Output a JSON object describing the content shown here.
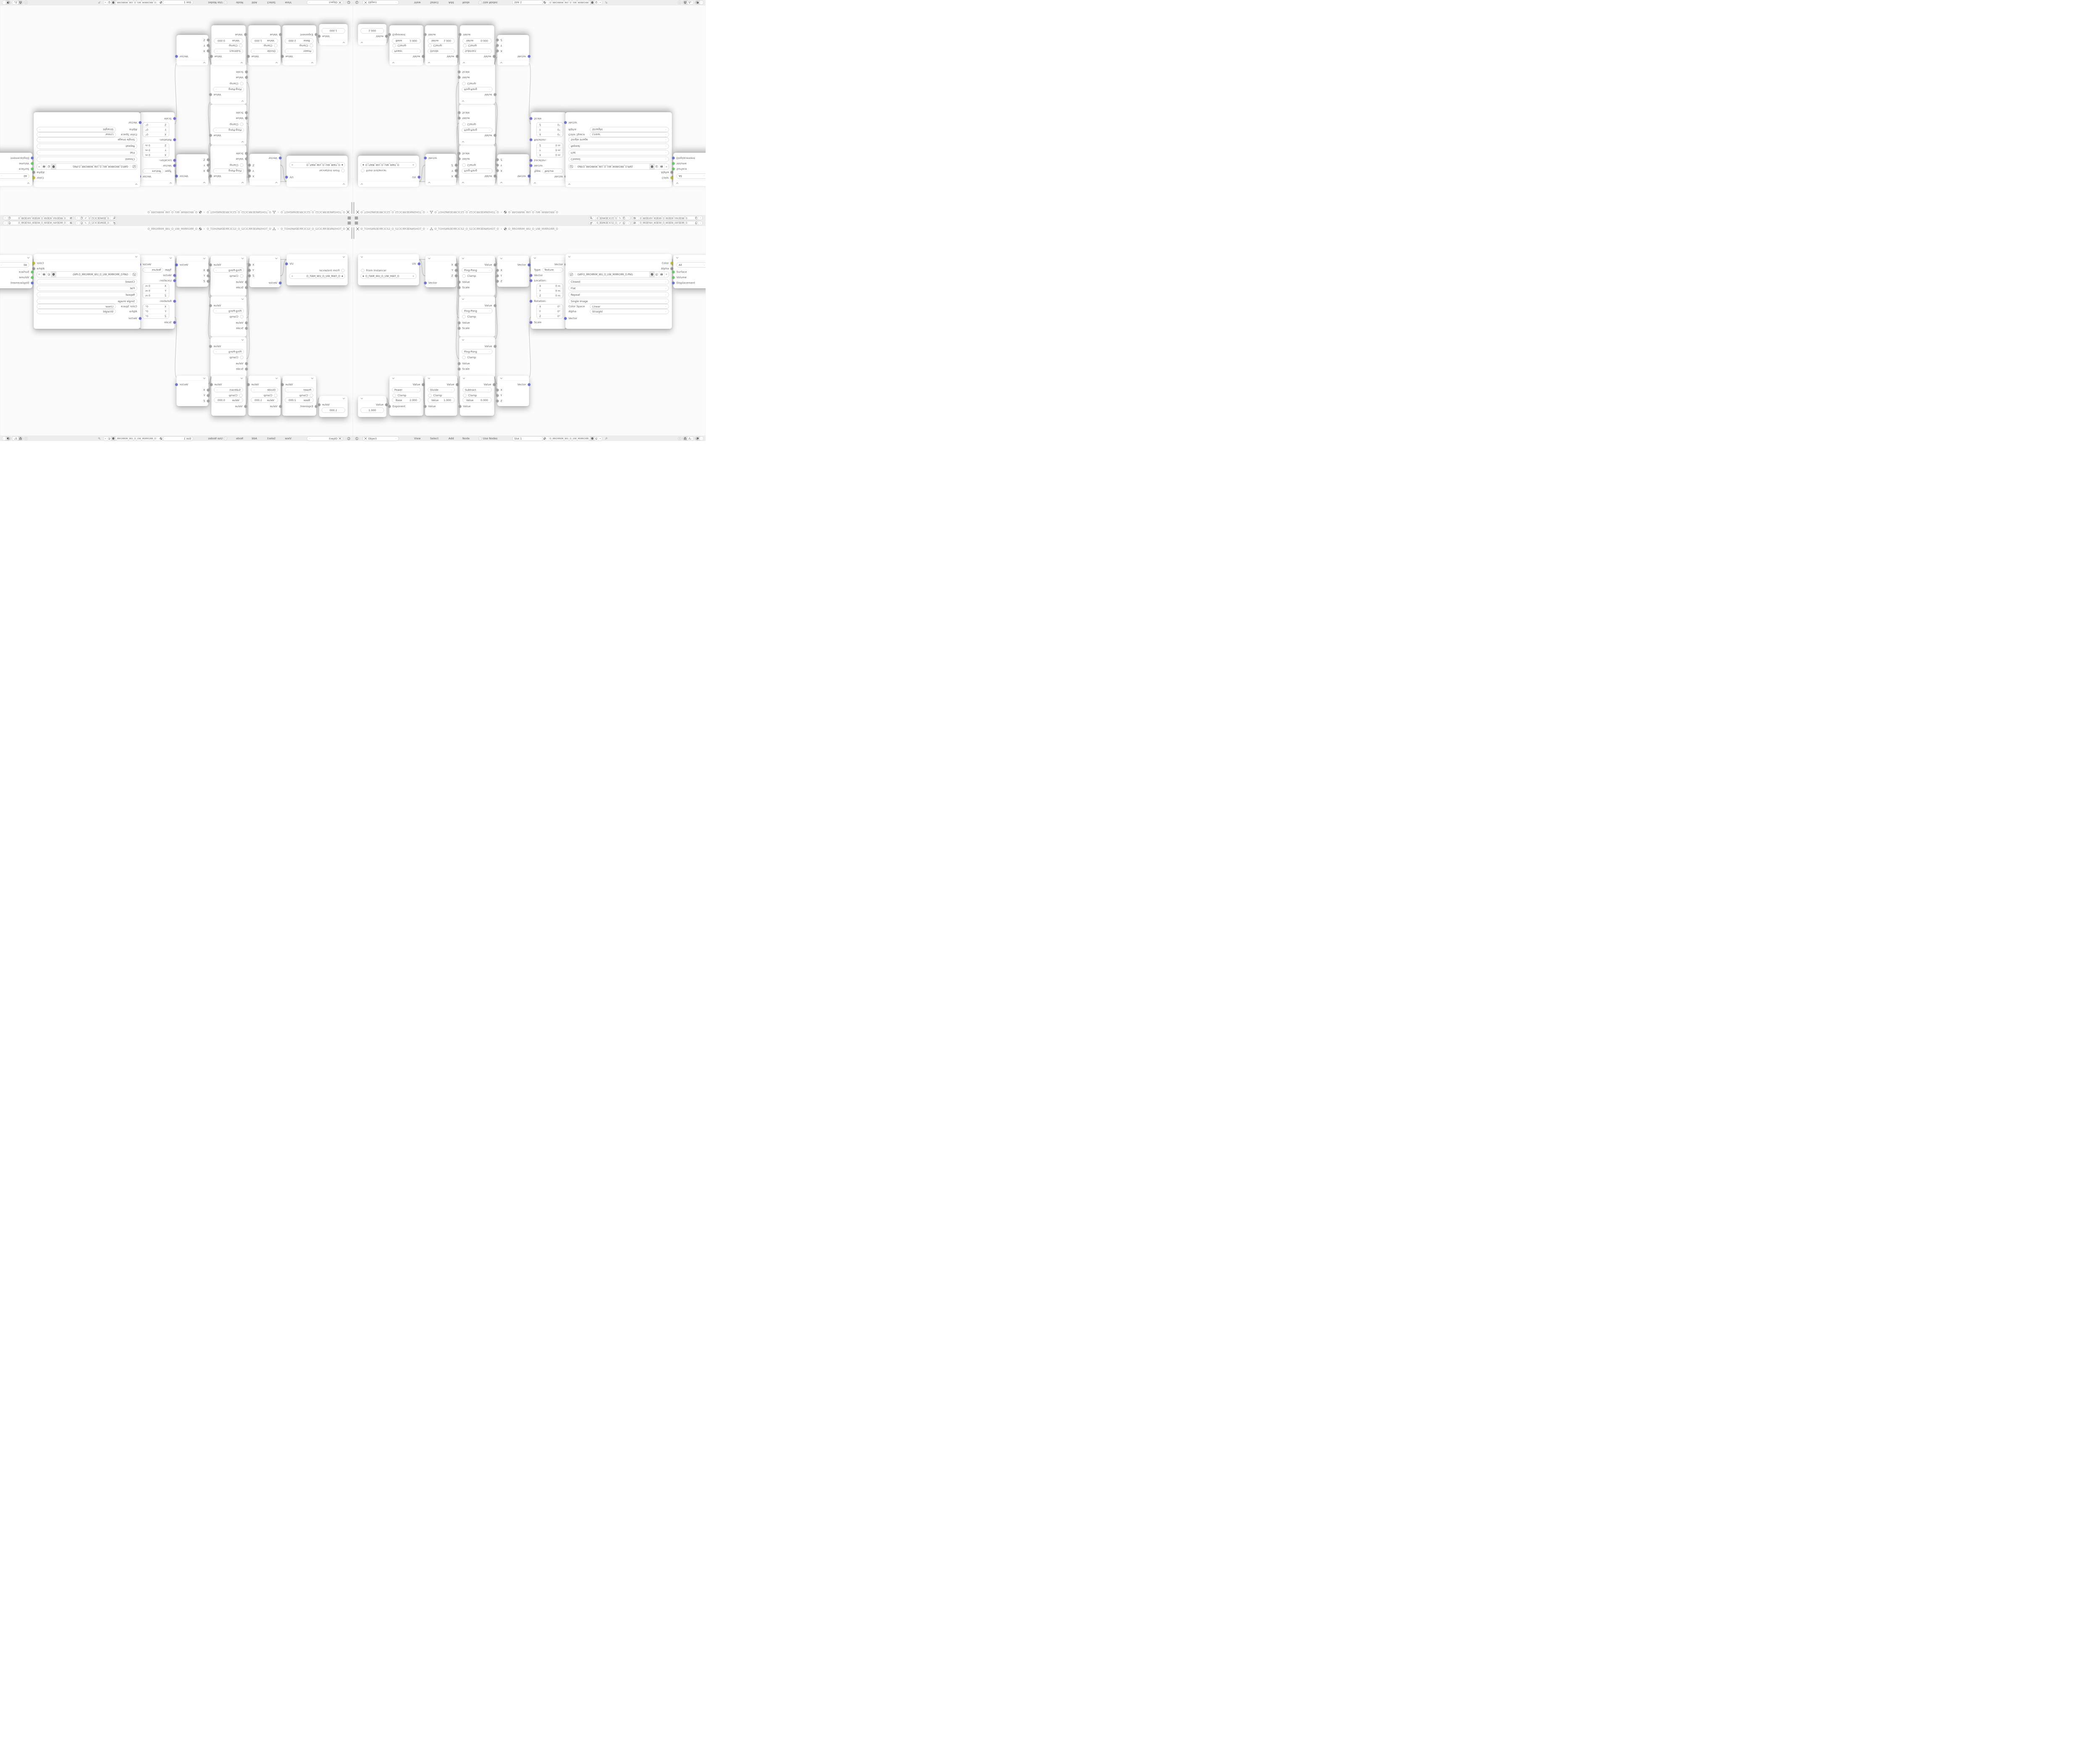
{
  "colors": {
    "bar_bg": "#ededee",
    "canvas_bg": "#fbfbfb",
    "node_bg": "#ffffff",
    "text": "#5f5f5f",
    "wire": "#c6c6c6",
    "pill_border": "#b9b9b9",
    "socket_vector": "#7173ce",
    "socket_value": "#a4a4a4",
    "socket_color": "#c9c932",
    "socket_shader": "#67c967",
    "scrollbar": "#cdcdcd"
  },
  "topbar": {
    "scene_name": "O_ƎEИNƎEƆCS2_O_S2ƆCƎEИ...",
    "view_layer_name": "O_ЯRƎEYAΛ_WƎEIW_O_WIƎEW_ΛAYƎEЯR_O"
  },
  "breadcrumb": {
    "separator": "›",
    "scene_path": "O_TOHSИNƎEЯRƆCS2_O_S2ƆCЯRƎENИSHOT_O",
    "object_path": "O_TOHSИNƎEЯRƆCS2_O_S2ƆCЯRƎENИSHOT_O",
    "material_path": "O_ЯROЯRIM_WU_O_UW_MIЯROЯR_O"
  },
  "header": {
    "shader_type": "Object",
    "menus": [
      "View",
      "Select",
      "Add",
      "Node"
    ],
    "use_nodes": "Use Nodes",
    "slot": "Slot 1",
    "material_name": "O_ЯROЯRIM_WU_O_UW_MIЯROЯR_O"
  },
  "nodes": {
    "uv_map": {
      "output": "UV",
      "from_instancer": "From Instancer",
      "uv_name": "O_ПAM_WU_O_UW_MAП_O"
    },
    "separate_xyz": {
      "out_x": "X",
      "out_y": "Y",
      "out_z": "Z",
      "input": "Vector"
    },
    "math_ping_pong": {
      "output": "Value",
      "operation": "Ping-Pong",
      "clamp": "Clamp",
      "in_value": "Value",
      "in_scale": "Scale"
    },
    "combine_xyz": {
      "output": "Vector",
      "in_x": "X",
      "in_y": "Y",
      "in_z": "Z"
    },
    "mapping": {
      "output": "Vector",
      "type_label": "Type:",
      "type": "Texture",
      "in_vector": "Vector",
      "location_label": "Location:",
      "rotation_label": "Rotation:",
      "scale_label": "Scale",
      "axes": [
        "X",
        "Y",
        "Z"
      ],
      "location_values": [
        "0 m",
        "0 m",
        "0 m"
      ],
      "rotation_values": [
        "0°",
        "0°",
        "0°"
      ]
    },
    "image_texture": {
      "out_color": "Color",
      "out_alpha": "Alpha",
      "filename": "GИP.O_ЯROЯRIM_WU_O_UW_MIЯROЯR_O.PNG",
      "interpolation": "Closest",
      "projection": "Flat",
      "extension": "Repeat",
      "source": "Single Image",
      "color_space_label": "Color Space",
      "color_space": "Linear",
      "alpha_label": "Alpha",
      "alpha_mode": "Straight",
      "in_vector": "Vector"
    },
    "material_output": {
      "target": "All",
      "in_surface": "Surface",
      "in_volume": "Volume",
      "in_displacement": "Displacement"
    },
    "value": {
      "output": "Value",
      "value": "1.000"
    },
    "math_power": {
      "output": "Value",
      "operation": "Power",
      "clamp": "Clamp",
      "field_label": "Base",
      "field_value": "2.000",
      "input": "Exponent"
    },
    "math_divide": {
      "output": "Value",
      "operation": "Divide",
      "clamp": "Clamp",
      "field_label": "Value",
      "field_value": "1.000",
      "input": "Value"
    },
    "math_subtract": {
      "output": "Value",
      "operation": "Subtract",
      "clamp": "Clamp",
      "field_label": "Value",
      "field_value": "0.000",
      "input": "Value"
    }
  }
}
